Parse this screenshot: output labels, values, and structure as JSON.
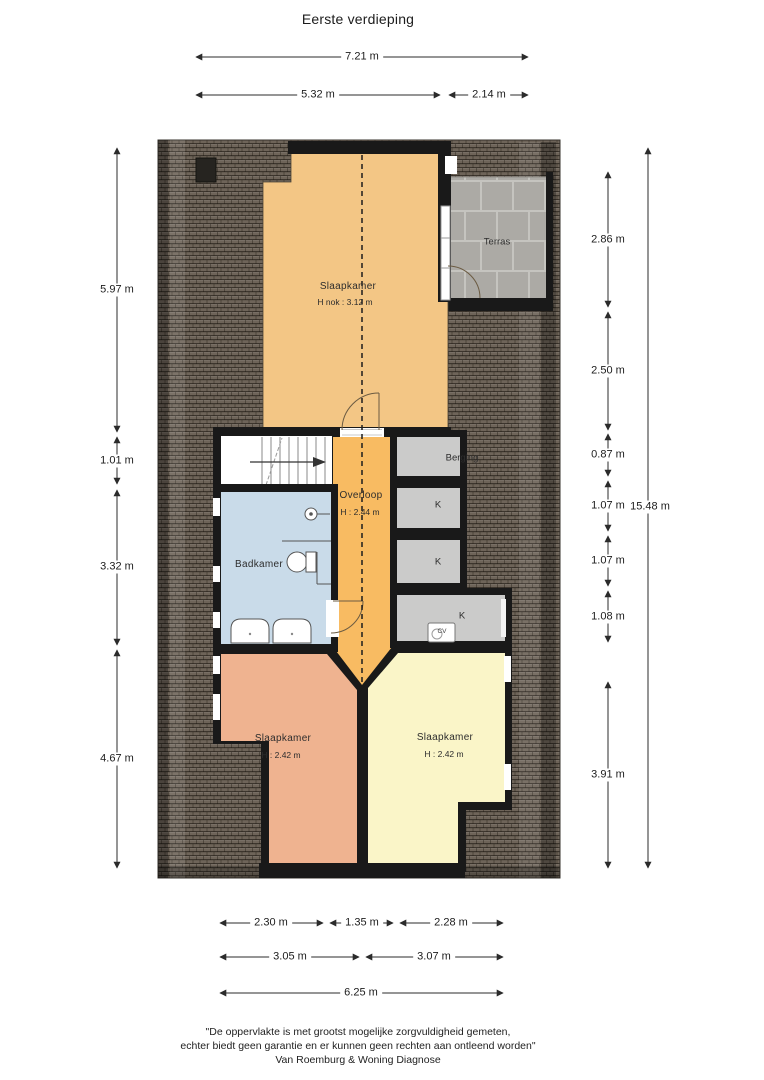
{
  "title": "Eerste verdieping",
  "dims": {
    "top": [
      {
        "label": "7.21 m"
      },
      {
        "label": "5.32 m"
      },
      {
        "label": "2.14 m"
      }
    ],
    "left": [
      {
        "label": "5.97 m"
      },
      {
        "label": "1.01 m"
      },
      {
        "label": "3.32 m"
      },
      {
        "label": "4.67 m"
      }
    ],
    "right": [
      {
        "label": "2.86 m"
      },
      {
        "label": "2.50 m"
      },
      {
        "label": "0.87 m"
      },
      {
        "label": "1.07 m"
      },
      {
        "label": "1.07 m"
      },
      {
        "label": "1.08 m"
      },
      {
        "label": "3.91 m"
      }
    ],
    "right_total": {
      "label": "15.48 m"
    },
    "bottom": [
      {
        "label": "2.30 m"
      },
      {
        "label": "1.35 m"
      },
      {
        "label": "2.28 m"
      },
      {
        "label": "3.05 m"
      },
      {
        "label": "3.07 m"
      },
      {
        "label": "6.25 m"
      }
    ]
  },
  "rooms": {
    "slaapkamer_top": {
      "name": "Slaapkamer",
      "height": "H nok : 3.12 m"
    },
    "terras": {
      "name": "Terras"
    },
    "overloop": {
      "name": "Overloop",
      "height": "H : 2.44 m"
    },
    "berging": {
      "name": "Berging"
    },
    "kast1": {
      "name": "K"
    },
    "kast2": {
      "name": "K"
    },
    "kast3": {
      "name": "K"
    },
    "cv": {
      "name": "CV"
    },
    "badkamer": {
      "name": "Badkamer"
    },
    "slaapkamer_left": {
      "name": "Slaapkamer",
      "height": "H : 2.42 m"
    },
    "slaapkamer_right": {
      "name": "Slaapkamer",
      "height": "H : 2.42 m"
    }
  },
  "footer": {
    "line1": "\"De oppervlakte is met grootst mogelijke zorgvuldigheid gemeten,",
    "line2": "echter biedt geen garantie en er kunnen geen rechten aan ontleend worden\"",
    "line3": "Van Roemburg & Woning Diagnose"
  },
  "colors": {
    "roof": "#6e6459",
    "wall": "#191919",
    "bedroom_top": "#f3c685",
    "overloop": "#f8bb62",
    "badkamer": "#c9dbe9",
    "bedroom_left": "#efb390",
    "bedroom_right": "#faf5c8",
    "closet_gray": "#cbcbca",
    "terrace_tile": "#acaaa5"
  }
}
